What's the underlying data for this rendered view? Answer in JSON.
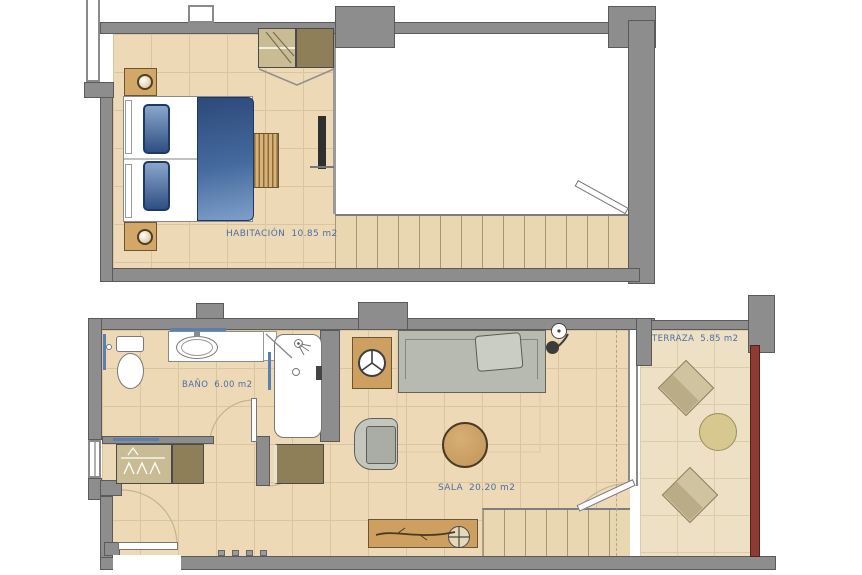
{
  "plans": {
    "upper": {
      "room": {
        "name": "HABITACIÓN",
        "area": "10.85 m2"
      }
    },
    "lower": {
      "bathroom": {
        "name": "BAÑO",
        "area": "6.00 m2"
      },
      "living": {
        "name": "SALA",
        "area": "20.20 m2"
      },
      "terrace": {
        "name": "TERRAZA",
        "area": "5.85 m2"
      }
    }
  },
  "colors": {
    "wall_gray": "#8d8d8d",
    "floor_tan": "#edd9b6",
    "terrace_floor": "#eee0c4",
    "label_blue": "#4a6fa5",
    "duvet_blue": "#2c4a7a",
    "sofa_gray": "#b6bab0",
    "wood": "#cd9f61",
    "closet_brown": "#8f7f59",
    "railing_maroon": "#8e3b34"
  }
}
